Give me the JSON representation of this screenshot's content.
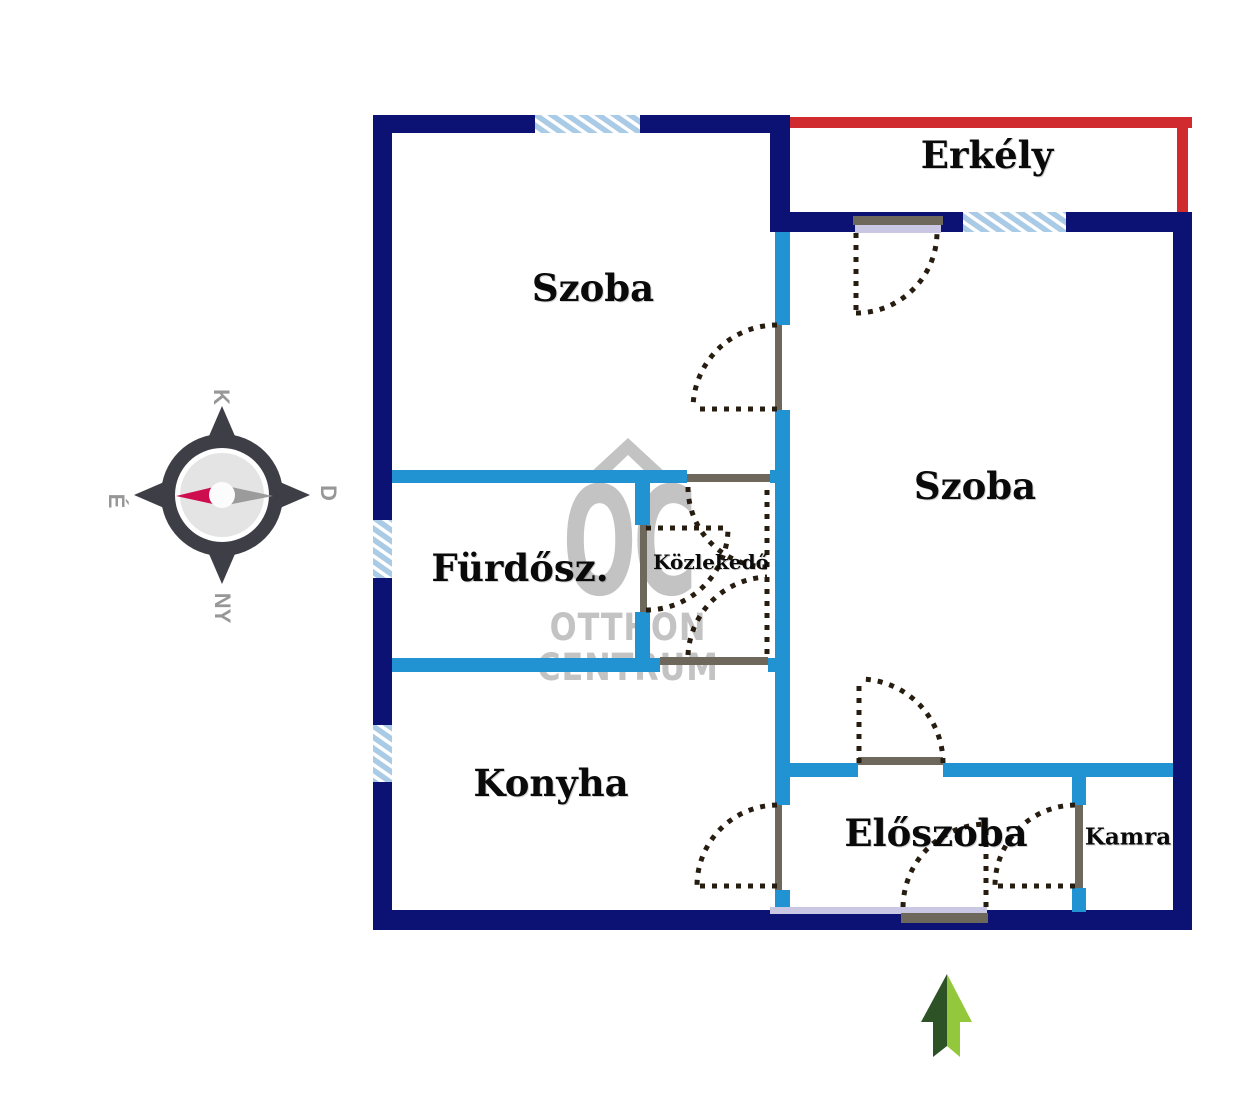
{
  "rooms": {
    "szoba_top": {
      "label": "Szoba"
    },
    "szoba_right": {
      "label": "Szoba"
    },
    "erkely": {
      "label": "Erkély"
    },
    "furdoszoba": {
      "label": "Fürdősz."
    },
    "kozlekedo": {
      "label": "Közlekedő"
    },
    "konyha": {
      "label": "Konyha"
    },
    "eloszoba": {
      "label": "Előszoba"
    },
    "kamra": {
      "label": "Kamra"
    }
  },
  "compass": {
    "k_label": "K",
    "d_label": "D",
    "ny_label": "NY",
    "e_label": "É"
  },
  "watermark": {
    "logo": "OC",
    "line1": "OTTHON",
    "line2": "CENTRUM"
  },
  "colors": {
    "exterior_wall": "#0b1274",
    "interior_wall": "#2293d2",
    "balcony_outline": "#d02c30",
    "window_glass": "#aacbe6",
    "door_frame": "#6e685c",
    "door_panel": "#c9c7e4",
    "door_swing": "#271c10",
    "watermark": "#c3c3c3",
    "compass_ring": "#3e3e46",
    "compass_needle_north": "#ce0d4e",
    "compass_needle_south": "#9b9b9b",
    "arrow_dark_green": "#2d5226",
    "arrow_light_green": "#93c83c"
  }
}
